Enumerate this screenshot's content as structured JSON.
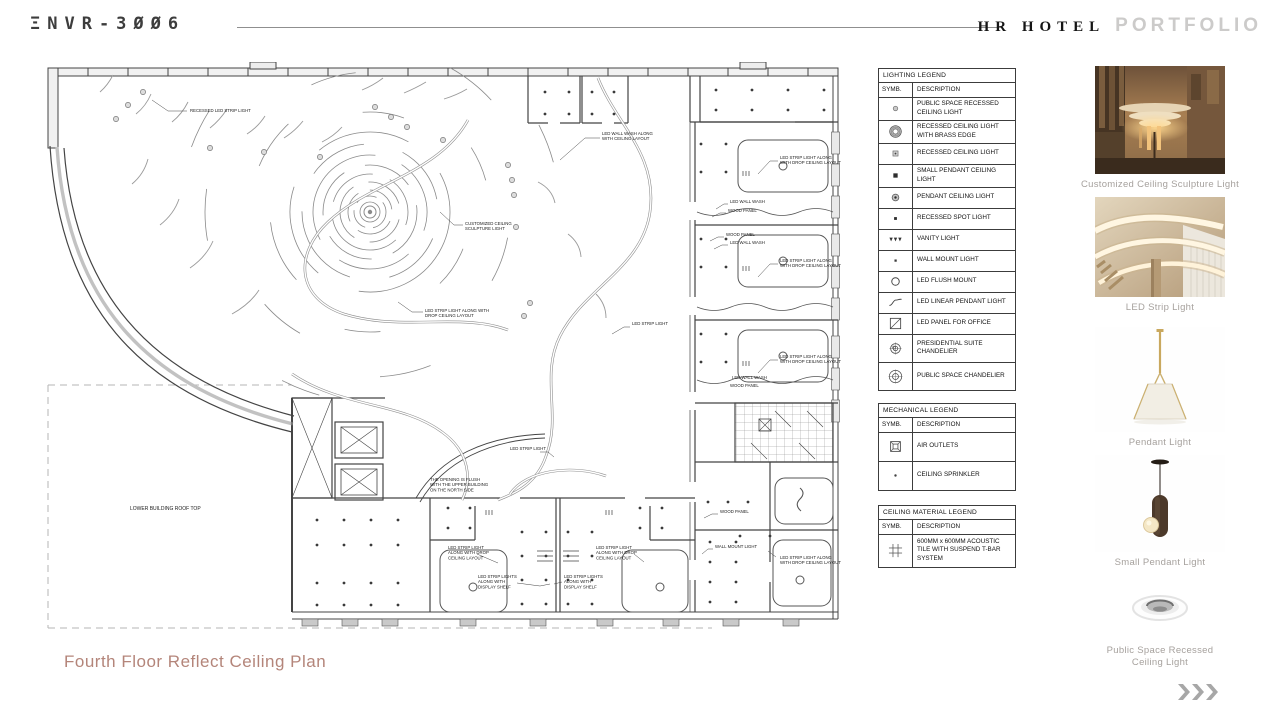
{
  "header": {
    "logo": "ΞNVR-3ØØ6",
    "logo_text": "ENVR-3006",
    "brand_serif": "HR HOTEL",
    "brand_light": "PORTFOLIO"
  },
  "footer": {
    "title": "Fourth Floor Reflect Ceiling Plan",
    "next_icon": "triple-chevron-right"
  },
  "legends": {
    "lighting": {
      "title": "LIGHTING LEGEND",
      "col_symbol": "SYMB.",
      "col_desc": "DESCRIPTION",
      "rows": [
        {
          "symbol": "recessedpublic",
          "desc": "PUBLIC SPACE RECESSED CEILING LIGHT"
        },
        {
          "symbol": "brass",
          "desc": "RECESSED CEILING LIGHT WITH BRASS EDGE"
        },
        {
          "symbol": "recessed",
          "desc": "RECESSED CEILING LIGHT"
        },
        {
          "symbol": "smallpendant",
          "desc": "SMALL PENDANT CEILING LIGHT"
        },
        {
          "symbol": "pendant",
          "desc": "PENDANT CEILING LIGHT"
        },
        {
          "symbol": "spot",
          "desc": "RECESSED SPOT LIGHT"
        },
        {
          "symbol": "vanity",
          "desc": "VANITY LIGHT"
        },
        {
          "symbol": "wallmount",
          "desc": "WALL MOUNT LIGHT"
        },
        {
          "symbol": "flush",
          "desc": "LED FLUSH MOUNT"
        },
        {
          "symbol": "linear",
          "desc": "LED LINEAR PENDANT LIGHT"
        },
        {
          "symbol": "panel",
          "desc": "LED PANEL FOR OFFICE"
        },
        {
          "symbol": "chandsuite",
          "desc": "PRESIDENTIAL SUITE CHANDELIER"
        },
        {
          "symbol": "chandpublic",
          "desc": "PUBLIC SPACE CHANDELIER"
        }
      ]
    },
    "mechanical": {
      "title": "MECHANICAL LEGEND",
      "col_symbol": "SYMB.",
      "col_desc": "DESCRIPTION",
      "rows": [
        {
          "symbol": "air",
          "desc": "AIR OUTLETS"
        },
        {
          "symbol": "sprinkler",
          "desc": "CEILING SPRINKLER"
        }
      ]
    },
    "ceiling": {
      "title": "CEILING MATERIAL LEGEND",
      "col_symbol": "SYMB.",
      "col_desc": "DESCRIPTION",
      "rows": [
        {
          "symbol": "tile",
          "desc": "600MM x 600MM ACOUSTIC TILE WITH SUSPEND T-BAR SYSTEM"
        }
      ]
    }
  },
  "plan": {
    "annotations": [
      {
        "x": 150,
        "y": 50,
        "lines": [
          "RECESSED LED STRIP LIGHT"
        ],
        "leader": "112,38 128,49 147,49"
      },
      {
        "x": 562,
        "y": 73,
        "lines": [
          "LED WALL WASH ALONG",
          "WITH CEILING LAYOUT"
        ],
        "leader": "520,98 545,76 560,76"
      },
      {
        "x": 425,
        "y": 163,
        "lines": [
          "CUSTOMIZED CEILING",
          "SCULPTURE LIGHT"
        ],
        "leader": "400,150 414,163 423,163"
      },
      {
        "x": 385,
        "y": 250,
        "lines": [
          "LED STRIP LIGHT ALONG WITH",
          "DROP CEILING LAYOUT"
        ],
        "leader": "358,240 372,250 383,250"
      },
      {
        "x": 592,
        "y": 263,
        "lines": [
          "LED STRIP LIGHT"
        ],
        "leader": "572,272 584,265 590,265"
      },
      {
        "x": 470,
        "y": 388,
        "lines": [
          "LED STRIP LIGHT"
        ],
        "leader": "500,390 508,390 514,395"
      },
      {
        "x": 390,
        "y": 419,
        "lines": [
          "THE OPENING IS FLUSH",
          "WITH THE UPPER BUILDING",
          "ON THE NORTH SIDE"
        ]
      },
      {
        "x": 90,
        "y": 448,
        "size": 5,
        "lines": [
          "LOWER BUILDING ROOF TOP"
        ]
      },
      {
        "x": 740,
        "y": 97,
        "lines": [
          "LED STRIP LIGHT ALONG",
          "WITH DROP CEILING LAYOUT"
        ],
        "leader": "718,112 730,99 738,99"
      },
      {
        "x": 690,
        "y": 141,
        "lines": [
          "LED WALL WASH"
        ],
        "leader": "676,147 684,142 688,142"
      },
      {
        "x": 688,
        "y": 150,
        "lines": [
          "WOOD PANEL"
        ],
        "leader": "672,155 680,151 686,151"
      },
      {
        "x": 686,
        "y": 174,
        "lines": [
          "WOOD PANEL"
        ],
        "leader": "670,179 678,175 684,175"
      },
      {
        "x": 690,
        "y": 182,
        "lines": [
          "LED WALL WASH"
        ],
        "leader": "674,187 682,183 688,183"
      },
      {
        "x": 740,
        "y": 200,
        "lines": [
          "LED STRIP LIGHT ALONG",
          "WITH DROP CEILING LAYOUT"
        ],
        "leader": "718,215 730,202 738,202"
      },
      {
        "x": 740,
        "y": 296,
        "lines": [
          "LED STRIP LIGHT ALONG",
          "WITH DROP CEILING LAYOUT"
        ],
        "leader": "718,311 730,298 738,298"
      },
      {
        "x": 692,
        "y": 317,
        "lines": [
          "LED WALL WASH"
        ]
      },
      {
        "x": 690,
        "y": 325,
        "lines": [
          "WOOD PANEL"
        ]
      },
      {
        "x": 408,
        "y": 487,
        "lines": [
          "LED STRIP LIGHT",
          "ALONG WITH DROP",
          "CEILING LAYOUT"
        ],
        "leader": "437,492 458,501"
      },
      {
        "x": 556,
        "y": 487,
        "lines": [
          "LED STRIP LIGHT",
          "ALONG WITH DROP",
          "CEILING LAYOUT"
        ],
        "leader": "594,492 604,500"
      },
      {
        "x": 438,
        "y": 516,
        "lines": [
          "LED STRIP LIGHTS",
          "ALONG WITH",
          "DISPLAY SHELF"
        ],
        "leader": "477,521 500,524 510,522"
      },
      {
        "x": 524,
        "y": 516,
        "lines": [
          "LED STRIP LIGHTS",
          "ALONG WITH",
          "DISPLAY SHELF"
        ],
        "leader": "522,520 514,522"
      },
      {
        "x": 675,
        "y": 486,
        "lines": [
          "WALL MOUNT LIGHT"
        ],
        "leader": "662,492 668,487 673,487"
      },
      {
        "x": 680,
        "y": 451,
        "lines": [
          "WOOD PANEL"
        ],
        "leader": "664,456 672,452 678,452"
      },
      {
        "x": 740,
        "y": 497,
        "lines": [
          "LED STRIP LIGHT ALONG",
          "WITH DROP CEILING LAYOUT"
        ],
        "leader": "728,489 736,495"
      }
    ]
  },
  "products": [
    {
      "id": "sculpture",
      "label": "Customized Ceiling Sculpture Light"
    },
    {
      "id": "led-strip",
      "label": "LED Strip Light"
    },
    {
      "id": "pendant",
      "label": "Pendant Light"
    },
    {
      "id": "small-pendant",
      "label": "Small Pendant Light"
    },
    {
      "id": "recessed",
      "label": "Public Space Recessed\nCeiling Light"
    }
  ]
}
